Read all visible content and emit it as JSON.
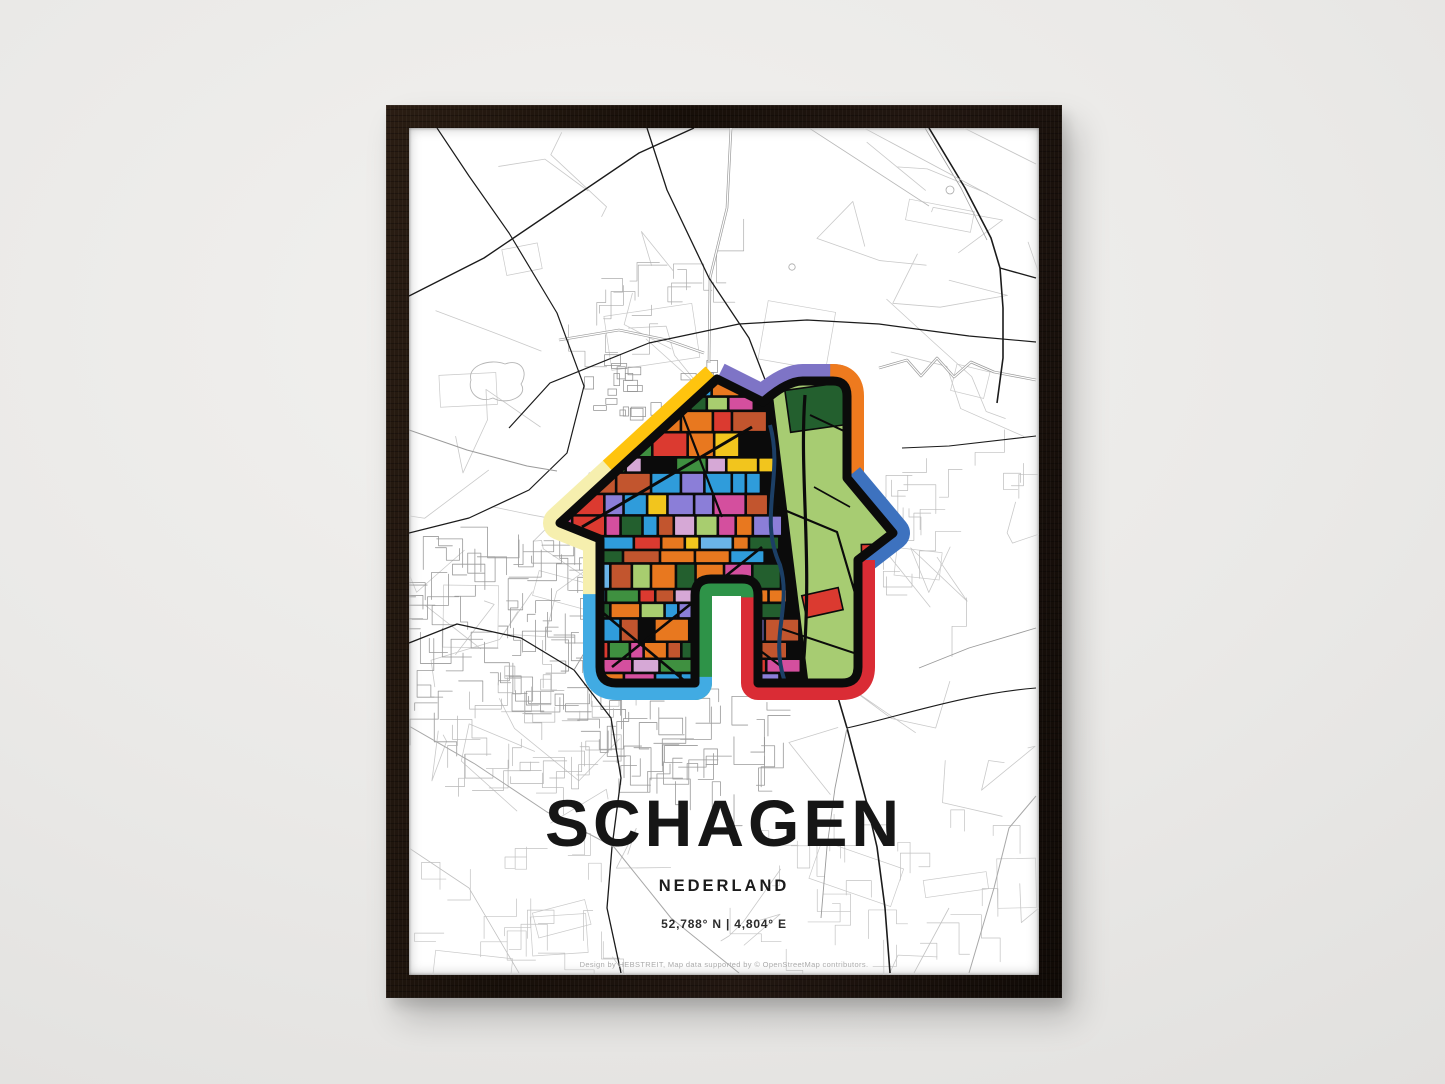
{
  "poster": {
    "title": "SCHAGEN",
    "subtitle": "NEDERLAND",
    "coordinates": "52,788° N | 4,804° E",
    "attribution": "Design by HEBSTREIT, Map data supported by © OpenStreetMap contributors."
  },
  "colors": {
    "wall": "#e9e8e6",
    "frame_wood": "#17100a",
    "poster_bg": "#ffffff",
    "map_major": "#1b1b1b",
    "map_medium": "#8f8f8f",
    "map_faint": "#c9c9c9",
    "outline_black": "#0b0b0b",
    "mosaic_base": "#a7cc72",
    "house_border": {
      "purple": "#7e74c6",
      "orange": "#ee7a1e",
      "blue": "#3d72bf",
      "red": "#da2c35",
      "green": "#2e9348",
      "cyan": "#41abe3",
      "cream": "#f6efae",
      "yellow": "#ffc40e"
    },
    "mosaic_palette": [
      "#e8781f",
      "#2f9cdb",
      "#db3a30",
      "#f2c51d",
      "#8b7ed8",
      "#d44f9e",
      "#a8cd6f",
      "#3f9040",
      "#d6a8d6",
      "#235f2e",
      "#2f9cdb",
      "#e8781f",
      "#2f9cdb",
      "#e8781f",
      "#6ab4e8",
      "#c2552e",
      "#e8781f",
      "#2f9cdb"
    ],
    "patch_palette": [
      "#e8781f",
      "#2f9cdb",
      "#d6a8d6",
      "#235f2e",
      "#db3a30",
      "#f2c51d",
      "#e8781f",
      "#2f9cdb"
    ],
    "canal_navy": "#1c3f66"
  },
  "house_border_segments": [
    {
      "color": "purple",
      "start": 0,
      "end": 98
    },
    {
      "color": "orange",
      "start": 98,
      "end": 177
    },
    {
      "color": "blue",
      "start": 177,
      "end": 266
    },
    {
      "color": "red",
      "start": 266,
      "end": 499
    },
    {
      "color": "green",
      "start": 499,
      "end": 626
    },
    {
      "color": "cyan",
      "start": 626,
      "end": 766
    },
    {
      "color": "cream",
      "start": 766,
      "end": 897
    },
    {
      "color": "yellow",
      "start": 897,
      "end": 1000
    }
  ],
  "render_seed": 20
}
